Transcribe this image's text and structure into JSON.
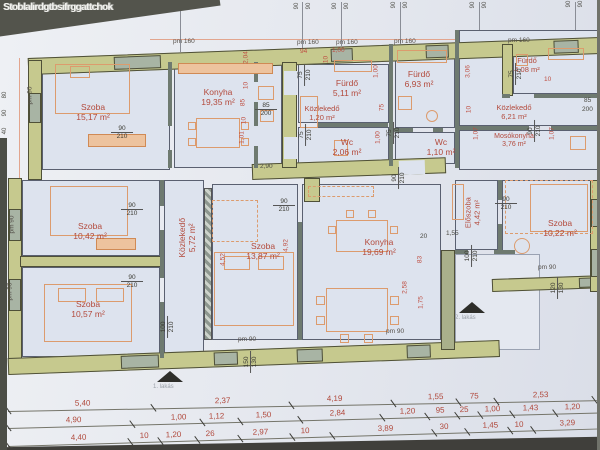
{
  "watermark": "Stoblalirdgtbsifrggattchok",
  "colors": {
    "wall_olive": "#c6c98e",
    "window_gray": "#a8b4a4",
    "paper": "#e8eaf0",
    "room_fill": "#dde3ee",
    "label_red": "#b34a3c",
    "dim_red": "#bf4f42"
  },
  "rooms": [
    {
      "name": "Szoba",
      "area": "15,17 m²"
    },
    {
      "name": "Konyha",
      "area": "19,35 m²"
    },
    {
      "name": "Közlekedő",
      "area": "1,20 m²"
    },
    {
      "name": "Fürdő",
      "area": "5,11 m²"
    },
    {
      "name": "Wc",
      "area": "2,06 m²"
    },
    {
      "name": "Fürdő",
      "area": "6,93 m²"
    },
    {
      "name": "Wc",
      "area": "1,10 m²"
    },
    {
      "name": "Közlekedő",
      "area": "6,21 m²"
    },
    {
      "name": "Mosókonyha",
      "area": "3,76 m²"
    },
    {
      "name": "Fürdő",
      "area": "4,08 m²"
    },
    {
      "name": "Szoba",
      "area": "10,42 m²"
    },
    {
      "name": "Közlekedő",
      "area": "5,72 m²"
    },
    {
      "name": "Szoba",
      "area": "13,87 m²"
    },
    {
      "name": "Konyha",
      "area": "19,69 m²"
    },
    {
      "name": "Szoba",
      "area": "10,57 m²"
    },
    {
      "name": "Előszoba",
      "area": "4,42 m²"
    },
    {
      "name": "Szoba",
      "area": "10,22 m²"
    }
  ],
  "door_labels": [
    {
      "w": "90",
      "h": "210"
    },
    {
      "w": "85",
      "h": "200"
    },
    {
      "w": "90",
      "h": "210"
    },
    {
      "w": "90",
      "h": "210"
    },
    {
      "w": "90",
      "h": "210"
    },
    {
      "w": "90",
      "h": "210"
    },
    {
      "w": "90",
      "h": "210"
    },
    {
      "w": "75",
      "h": "210"
    },
    {
      "w": "75",
      "h": "210"
    },
    {
      "w": "75",
      "h": "210"
    },
    {
      "w": "75",
      "h": "210"
    },
    {
      "w": "90",
      "h": "210"
    },
    {
      "w": "100",
      "h": "210"
    },
    {
      "w": "100",
      "h": "210"
    },
    {
      "w": "150",
      "h": "130"
    },
    {
      "w": "120",
      "h": "130"
    }
  ],
  "red_dims": [
    "2,04",
    "10",
    "85",
    "10",
    "1,01",
    "94",
    "1,00",
    "10",
    "1,00",
    "75",
    "1,00",
    "3,06",
    "10",
    "1,07",
    "10",
    "1,07",
    "2,90",
    "20",
    "83",
    "2,58",
    "1,75",
    "4,52",
    "4,92",
    "1,55",
    "85",
    "200"
  ],
  "pm160": [
    "pm 160",
    "pm 160",
    "pm 160",
    "pm 160",
    "pm 160"
  ],
  "pm90": [
    "pm 90",
    "pm 90",
    "pm 90",
    "pm 90",
    "pm 90",
    "pm 90"
  ],
  "top_ticks": [
    "90",
    "90",
    "90",
    "90",
    "90",
    "90",
    "90",
    "90",
    "90",
    "90",
    "90",
    "90"
  ],
  "left_ticks": [
    "80",
    "90",
    "40"
  ],
  "apartments": [
    "1. lakás",
    "2. lakás"
  ],
  "dim_rows": {
    "row1": [
      "5,40",
      "2,37",
      "4,19",
      "1,55",
      "75",
      "2,53"
    ],
    "row2": [
      "4,90",
      "1,00",
      "1,12",
      "1,50",
      "2,84",
      "1,20",
      "95",
      "25",
      "1,00",
      "1,43",
      "1,20"
    ],
    "row3": [
      "4,40",
      "10",
      "1,20",
      "26",
      "2,97",
      "10",
      "3,89",
      "30",
      "1,45",
      "10",
      "3,29"
    ],
    "row4": [
      "4,84"
    ]
  }
}
